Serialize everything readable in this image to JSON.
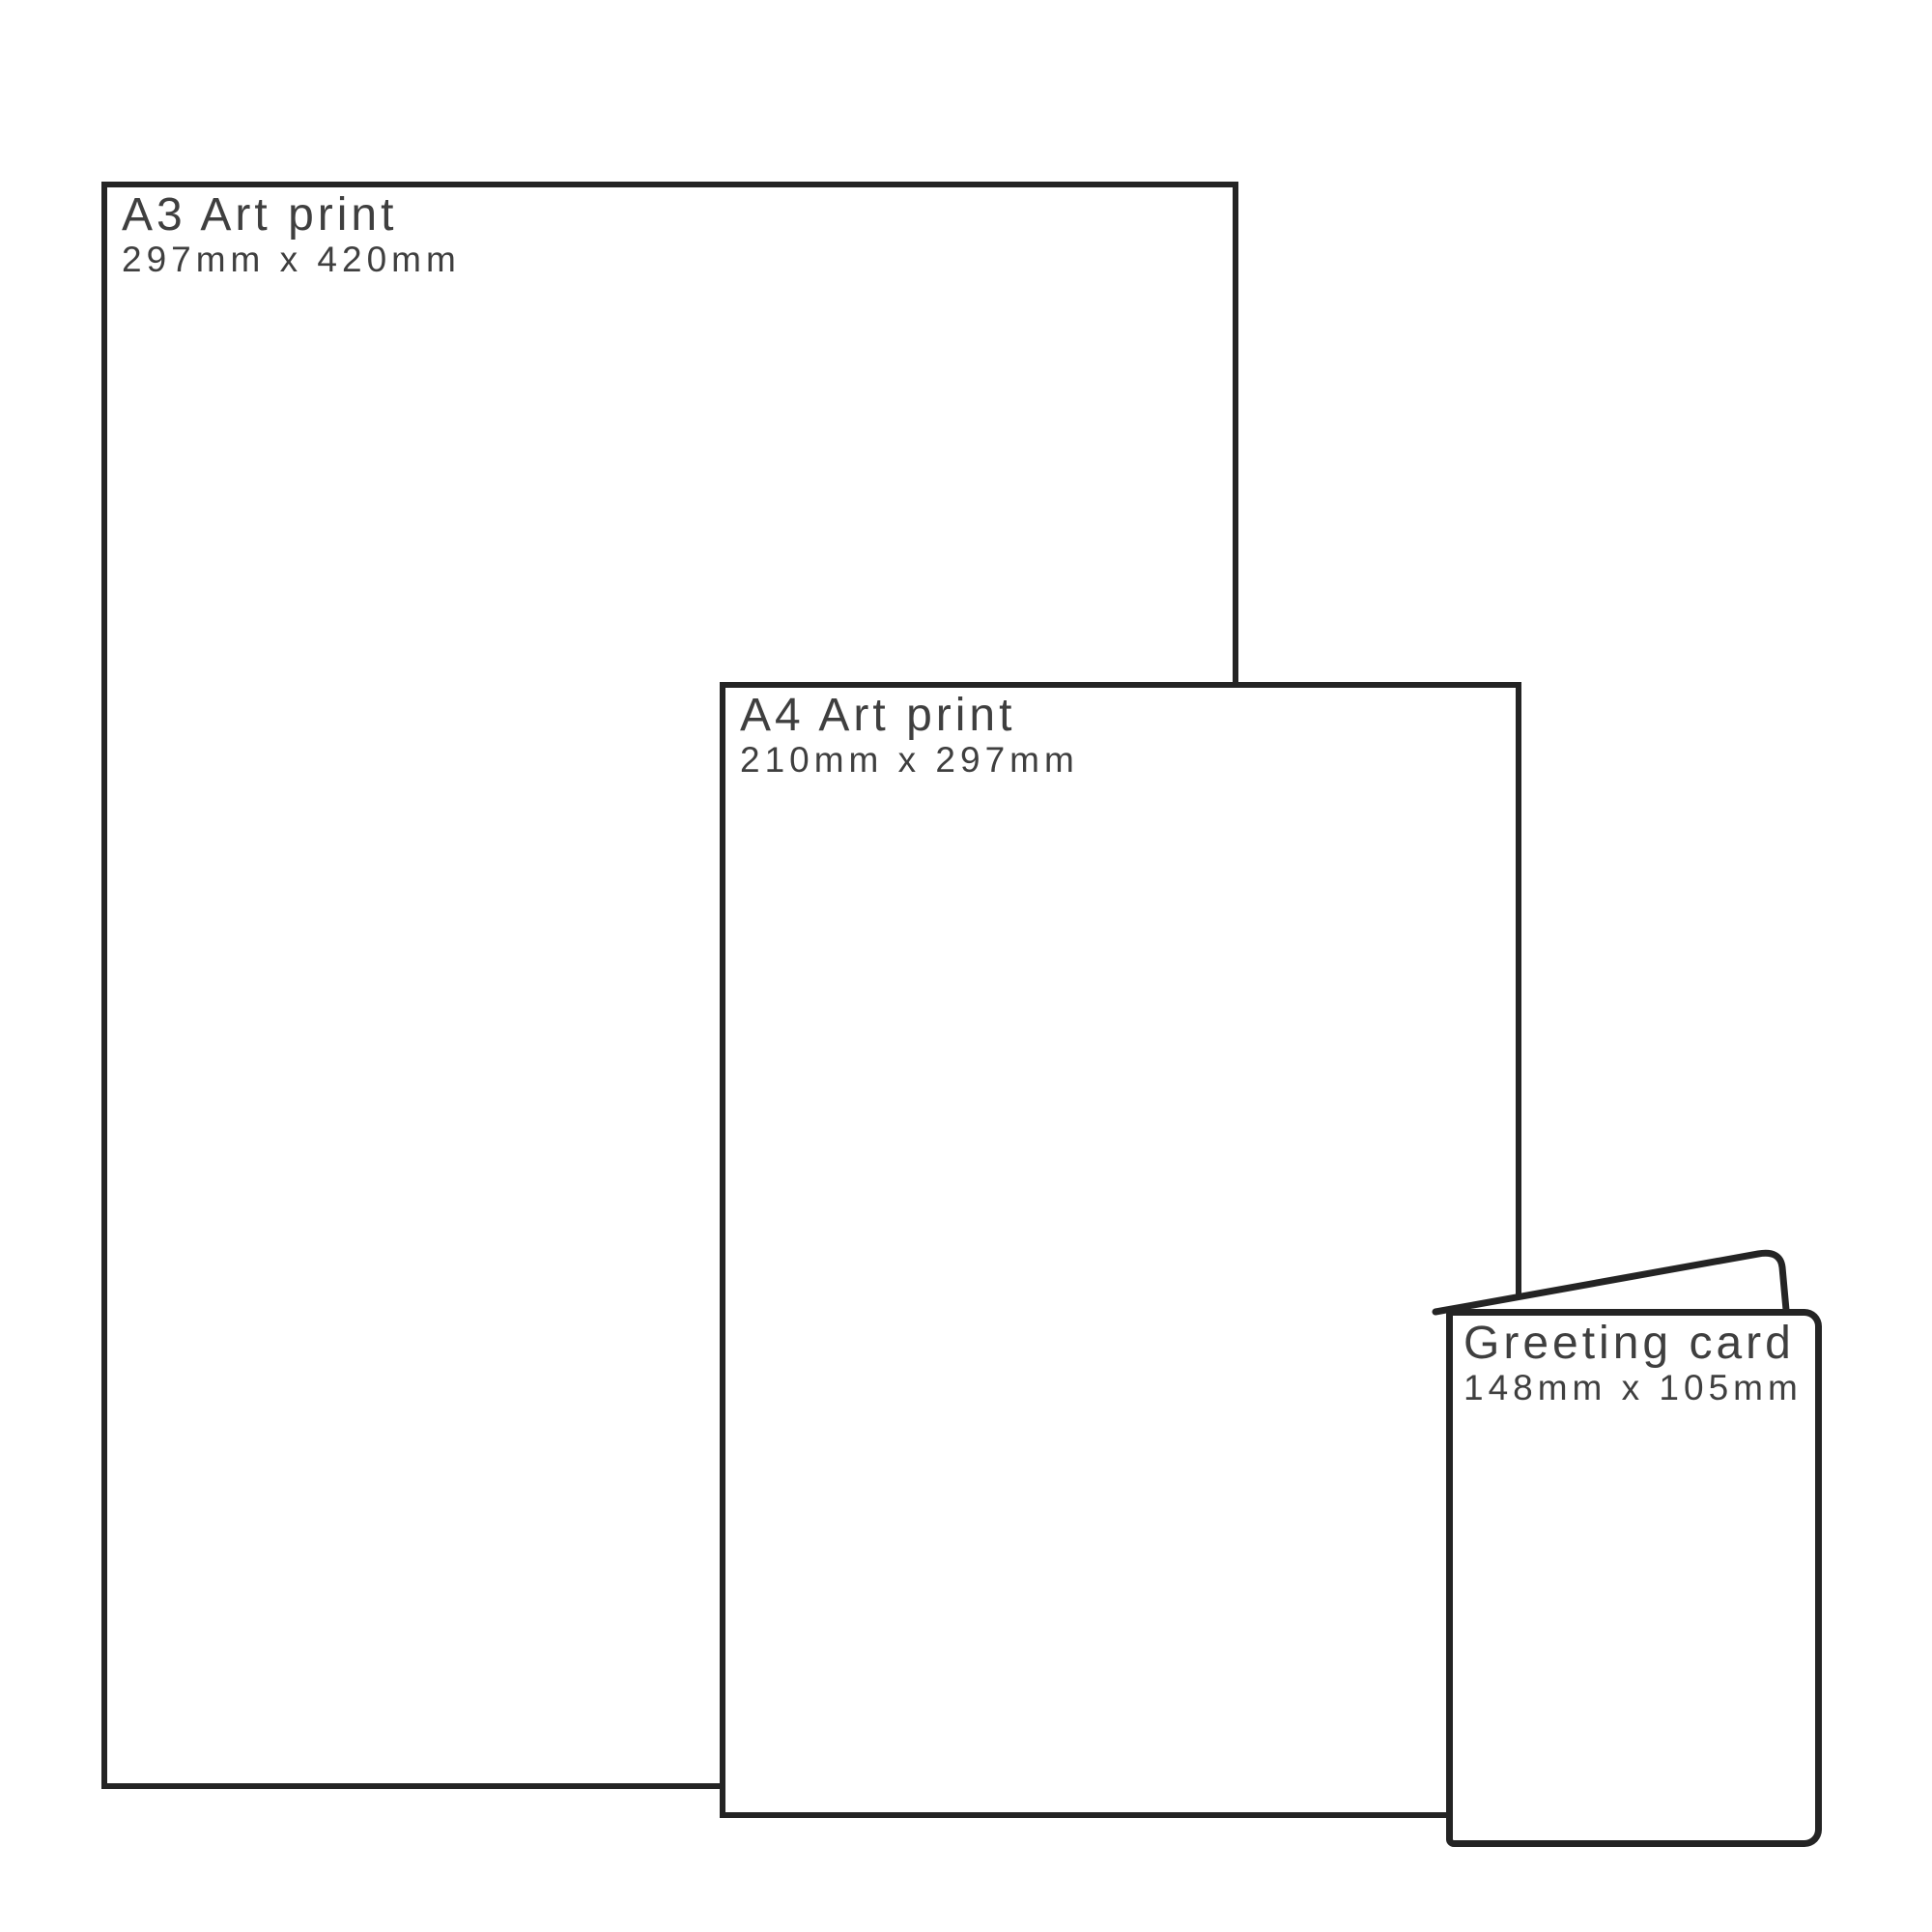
{
  "colors": {
    "line": "#242424",
    "text": "#3f3f3f",
    "background": "#ffffff"
  },
  "items": {
    "a3": {
      "title": "A3 Art print",
      "dimensions": "297mm x 420mm"
    },
    "a4": {
      "title": "A4 Art print",
      "dimensions": "210mm x 297mm"
    },
    "card": {
      "title": "Greeting card",
      "dimensions": "148mm x 105mm"
    }
  }
}
